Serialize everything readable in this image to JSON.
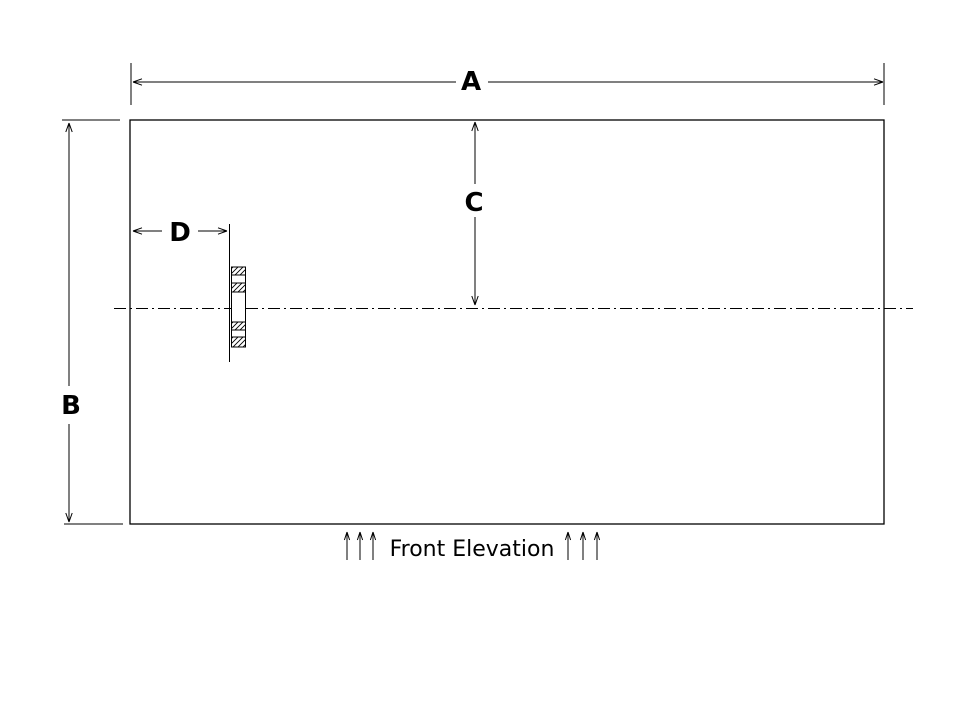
{
  "drawing": {
    "caption": "Front Elevation",
    "dim_a": "A",
    "dim_b": "B",
    "dim_c": "C",
    "dim_d": "D",
    "colors": {
      "line": "#000000",
      "background": "#ffffff"
    }
  }
}
